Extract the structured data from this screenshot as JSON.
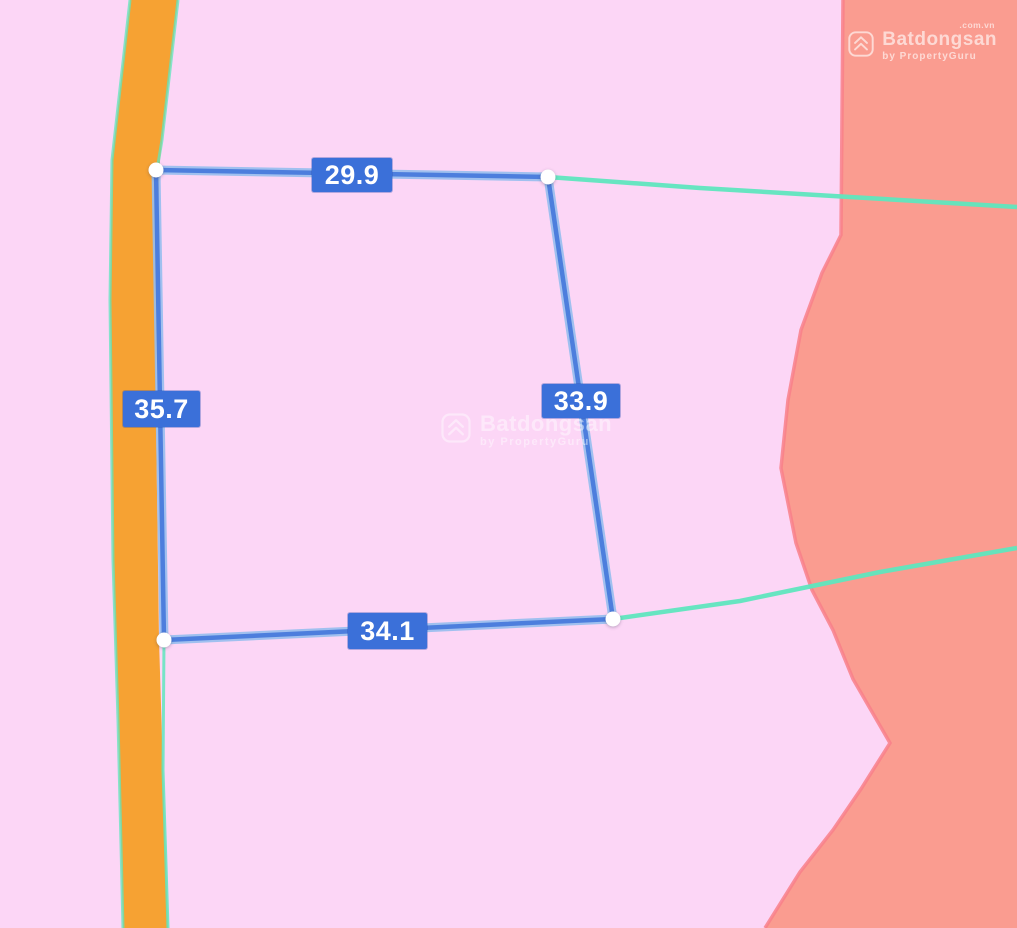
{
  "app": "Batdongsan map parcel measurement view",
  "colors": {
    "background_pink": "#FCD6F6",
    "adjacent_region_salmon": "#FA9C90",
    "region_edge_red": "#F8808A",
    "road_orange": "#F6A233",
    "cadastral_line_teal": "#5FE6BE",
    "measure_line_blue": "#4D7EDD",
    "measure_line_casing": "#96BEEE",
    "label_bg_blue": "#3B70D9",
    "label_text_white": "#FFFFFF"
  },
  "parcel": {
    "edge_labels": {
      "top": "29.9",
      "right": "33.9",
      "bottom": "34.1",
      "left": "35.7"
    }
  },
  "watermark": {
    "brand": "Batdongsan",
    "byline": "by PropertyGuru"
  },
  "logo": {
    "brand": "Batdongsan",
    "tld": ".com.vn",
    "byline": "by PropertyGuru"
  }
}
